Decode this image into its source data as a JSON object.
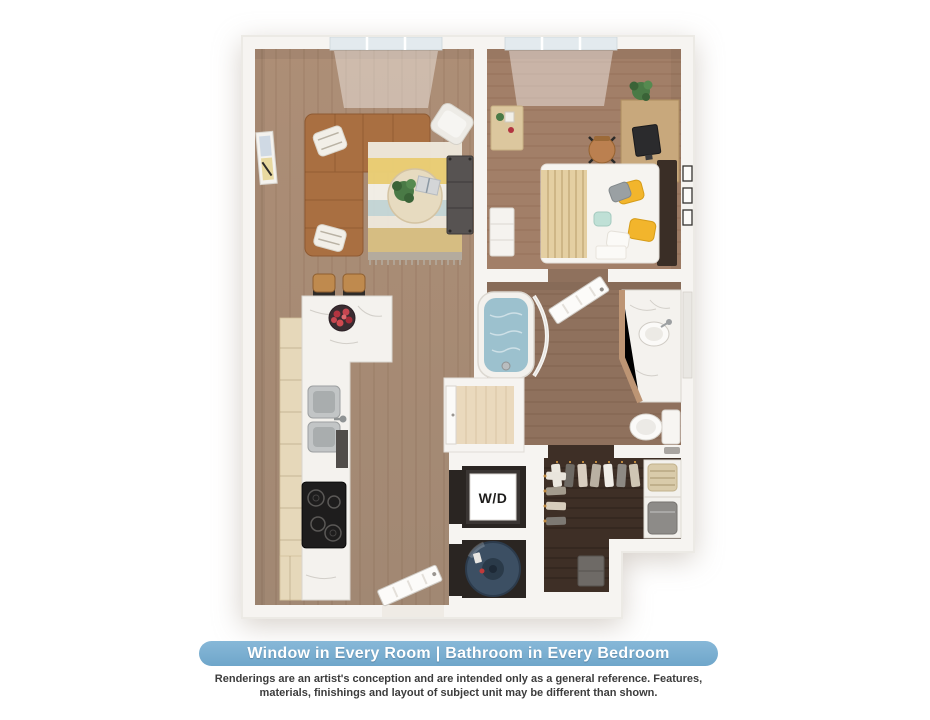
{
  "banner": {
    "text": "Window in Every Room | Bathroom in Every Bedroom",
    "background_color": "#7db1d4",
    "text_color": "#ffffff"
  },
  "disclaimer": {
    "line1": "Renderings are an artist's conception and are intended only as a general reference. Features,",
    "line2": "materials, finishings and layout of subject unit may be different than shown."
  },
  "floorplan": {
    "type": "3d-top-down-apartment-rendering",
    "labels": {
      "washer_dryer": "W/D"
    },
    "rooms": [
      {
        "name": "living-room",
        "furniture": [
          "L-shaped leather sectional sofa",
          "striped area rug",
          "round coffee table with plant and book",
          "white accent chair",
          "dark media console",
          "framed wall art"
        ]
      },
      {
        "name": "bedroom",
        "furniture": [
          "bed with yellow and teal pillows and tan throw",
          "desk with monitor",
          "office chair",
          "potted plant",
          "white dresser",
          "side console",
          "gallery wall frames"
        ]
      },
      {
        "name": "kitchen",
        "furniture": [
          "marble peninsula with two bar stools",
          "fruit bowl",
          "double stainless sink",
          "dishwasher",
          "black cooktop",
          "light wood cabinets"
        ]
      },
      {
        "name": "bathroom",
        "furniture": [
          "soaking tub with water",
          "curved shower rod",
          "corner marble vanity with sink",
          "toilet",
          "laundry hamper",
          "open door from bedroom"
        ]
      },
      {
        "name": "walk-in-closet",
        "furniture": [
          "hanging garments",
          "white shelving",
          "woven basket",
          "gray storage bin",
          "small gray dresser"
        ]
      },
      {
        "name": "laundry-closet",
        "furniture": [
          "stacked washer dryer unit"
        ]
      },
      {
        "name": "utility-closet",
        "furniture": [
          "water heater"
        ]
      },
      {
        "name": "linen-closet",
        "furniture": [
          "door"
        ]
      },
      {
        "name": "entry",
        "furniture": [
          "open entry door"
        ]
      }
    ],
    "colors": {
      "walls": "#f6f4f1",
      "wood_main": "#aa8c76",
      "wood_bedroom": "#a27f68",
      "wood_bathroom": "#8f715d",
      "wood_closet": "#3e2f26",
      "counter_marble": "#f4f2ee",
      "cabinet_wood": "#e6d8ba",
      "sofa_leather": "#a96f41",
      "pillow_yellow": "#f2b52c",
      "tub_water": "#9cc1ce",
      "water_heater": "#3c4f63"
    }
  }
}
